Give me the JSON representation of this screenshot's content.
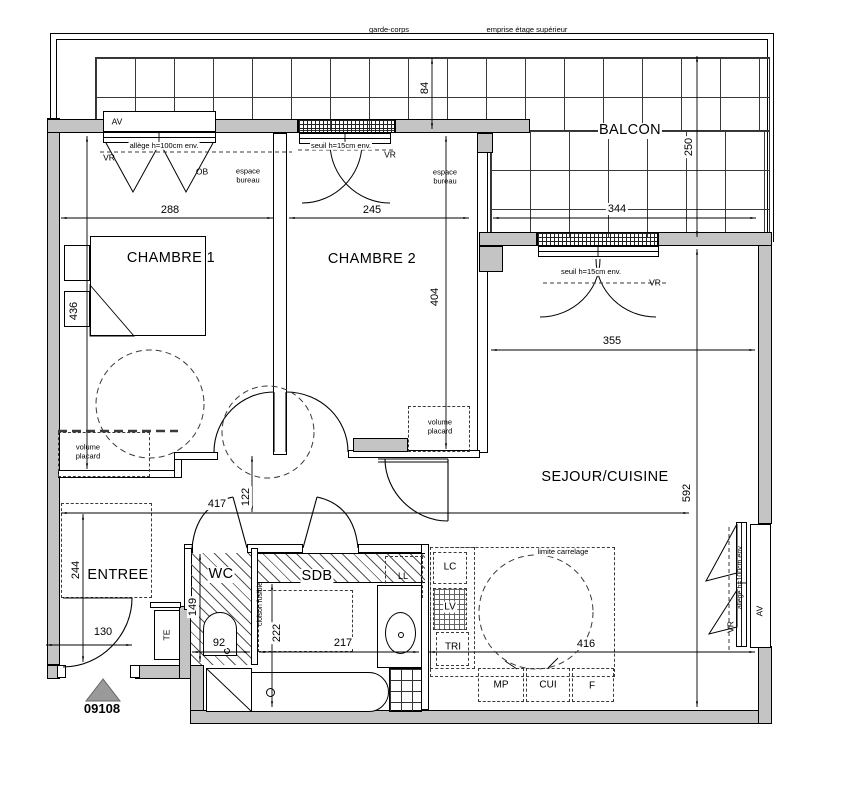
{
  "plan_number": "09108",
  "top": {
    "garde_corps": "garde-corps",
    "emprise": "emprise étage supérieur"
  },
  "rooms": {
    "balcon": "BALCON",
    "chambre1": "CHAMBRE 1",
    "chambre2": "CHAMBRE 2",
    "sejour": "SEJOUR/CUISINE",
    "entree": "ENTREE",
    "wc": "WC",
    "sdb": "SDB"
  },
  "annotations": {
    "av": "AV",
    "vr": "VR",
    "ob": "OB",
    "allege": "allège h=100cm env.",
    "seuil": "seuil h=15cm env.",
    "espace_bureau": "espace bureau",
    "volume_placard": "volume placard",
    "cloison_fusible": "cloison fusible",
    "limite_carrelage": "limite carrelage",
    "te": "TE",
    "ll": "LL",
    "lc": "LC",
    "lv": "LV",
    "tri": "TRI",
    "mp": "MP",
    "cui": "CUI",
    "f": "F"
  },
  "dimensions": {
    "balcon_strip": "84",
    "balcon_depth": "250",
    "balcon_width": "344",
    "chambre1_width": "288",
    "chambre2_width": "245",
    "chambre1_depth": "436",
    "chambre2_depth": "404",
    "sejour_width": "355",
    "sejour_depth": "592",
    "hall_length": "417",
    "hall_width": "122",
    "entree_depth": "244",
    "entree_door": "130",
    "wc_depth": "149",
    "wc_width": "92",
    "sdb_depth": "222",
    "sdb_width": "217",
    "cuisine_width": "416"
  },
  "colors": {
    "wall_fill": "#c4c4c4",
    "line": "#000000",
    "marker_fill": "#9a9a9a"
  }
}
